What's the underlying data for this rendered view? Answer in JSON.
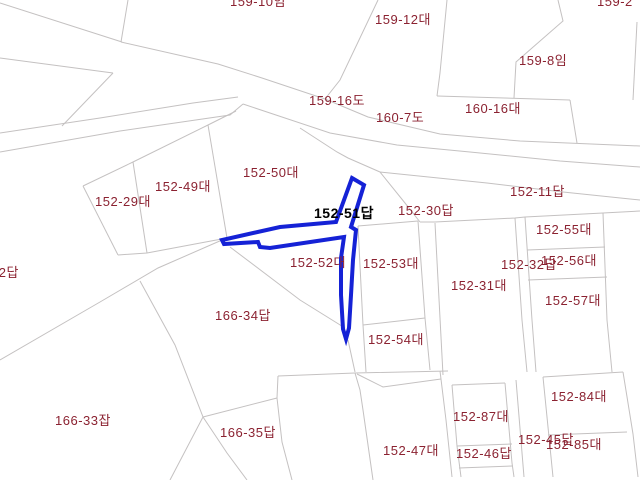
{
  "map": {
    "type": "cadastral-parcel-map",
    "background_color": "#ffffff",
    "boundary_line_color": "#c4c1c1",
    "parcel_label_color": "#8b2231",
    "highlight_outline_color": "#1522d6",
    "highlight_label_color": "#000000",
    "highlighted_parcel": {
      "label": "152-51답",
      "label_x": 314,
      "label_y": 206,
      "outline_points": [
        [
          352,
          178
        ],
        [
          364,
          185
        ],
        [
          351,
          227
        ],
        [
          356,
          230
        ],
        [
          353,
          260
        ],
        [
          351,
          295
        ],
        [
          349,
          328
        ],
        [
          346,
          339
        ],
        [
          343,
          329
        ],
        [
          341,
          295
        ],
        [
          341,
          258
        ],
        [
          344,
          237
        ],
        [
          270,
          248
        ],
        [
          260,
          247
        ],
        [
          258,
          242
        ],
        [
          224,
          244
        ],
        [
          222,
          240
        ],
        [
          280,
          227
        ],
        [
          336,
          222
        ]
      ]
    },
    "parcel_labels": [
      {
        "text": "159-10임",
        "x": 230,
        "y": -6
      },
      {
        "text": "159-12대",
        "x": 375,
        "y": 12
      },
      {
        "text": "159-2",
        "x": 597,
        "y": -6
      },
      {
        "text": "159-8임",
        "x": 519,
        "y": 53
      },
      {
        "text": "159-16도",
        "x": 309,
        "y": 93
      },
      {
        "text": "160-7도",
        "x": 376,
        "y": 110
      },
      {
        "text": "160-16대",
        "x": 465,
        "y": 101
      },
      {
        "text": "152-11답",
        "x": 510,
        "y": 184
      },
      {
        "text": "152-50대",
        "x": 243,
        "y": 165
      },
      {
        "text": "152-49대",
        "x": 155,
        "y": 179
      },
      {
        "text": "152-29대",
        "x": 95,
        "y": 194
      },
      {
        "text": "152-30답",
        "x": 398,
        "y": 203
      },
      {
        "text": "152-55대",
        "x": 536,
        "y": 222
      },
      {
        "text": "152-32답",
        "x": 501,
        "y": 257
      },
      {
        "text": "152-56대",
        "x": 541,
        "y": 253
      },
      {
        "text": "152-31대",
        "x": 451,
        "y": 278
      },
      {
        "text": "152-57대",
        "x": 545,
        "y": 293
      },
      {
        "text": "152-53대",
        "x": 363,
        "y": 256
      },
      {
        "text": "152-52대",
        "x": 290,
        "y": 255
      },
      {
        "text": "152-54대",
        "x": 368,
        "y": 332
      },
      {
        "text": "166-34답",
        "x": 215,
        "y": 308
      },
      {
        "text": "166-33잡",
        "x": 55,
        "y": 413
      },
      {
        "text": "166-35답",
        "x": 220,
        "y": 425
      },
      {
        "text": "152-87대",
        "x": 453,
        "y": 409
      },
      {
        "text": "152-47대",
        "x": 383,
        "y": 443
      },
      {
        "text": "152-46답",
        "x": 456,
        "y": 446
      },
      {
        "text": "152-84대",
        "x": 551,
        "y": 389
      },
      {
        "text": "152-45답",
        "x": 518,
        "y": 432
      },
      {
        "text": "152-85대",
        "x": 546,
        "y": 437
      },
      {
        "text": "32답",
        "x": -9,
        "y": 265
      }
    ],
    "boundary_lines": [
      [
        [
          0,
          3
        ],
        [
          122,
          42
        ]
      ],
      [
        [
          128,
          0
        ],
        [
          121,
          42
        ]
      ],
      [
        [
          121,
          42
        ],
        [
          218,
          64
        ],
        [
          262,
          78
        ],
        [
          325,
          99
        ]
      ],
      [
        [
          325,
          99
        ],
        [
          368,
          117
        ],
        [
          440,
          134
        ],
        [
          520,
          141
        ],
        [
          640,
          146
        ]
      ],
      [
        [
          0,
          58
        ],
        [
          113,
          73
        ]
      ],
      [
        [
          113,
          73
        ],
        [
          62,
          126
        ]
      ],
      [
        [
          0,
          133
        ],
        [
          100,
          118
        ],
        [
          193,
          103
        ],
        [
          238,
          97
        ]
      ],
      [
        [
          0,
          152
        ],
        [
          120,
          131
        ],
        [
          230,
          115
        ],
        [
          243,
          104
        ]
      ],
      [
        [
          243,
          104
        ],
        [
          330,
          133
        ],
        [
          397,
          145
        ],
        [
          470,
          152
        ],
        [
          560,
          161
        ],
        [
          640,
          167
        ]
      ],
      [
        [
          236,
          111
        ],
        [
          208,
          125
        ],
        [
          133,
          162
        ],
        [
          83,
          186
        ]
      ],
      [
        [
          83,
          186
        ],
        [
          118,
          255
        ]
      ],
      [
        [
          133,
          162
        ],
        [
          147,
          253
        ]
      ],
      [
        [
          118,
          255
        ],
        [
          147,
          253
        ],
        [
          227,
          238
        ]
      ],
      [
        [
          208,
          125
        ],
        [
          227,
          238
        ]
      ],
      [
        [
          300,
          128
        ],
        [
          337,
          152
        ],
        [
          348,
          158
        ],
        [
          380,
          172
        ]
      ],
      [
        [
          380,
          172
        ],
        [
          487,
          183
        ],
        [
          563,
          192
        ],
        [
          640,
          200
        ]
      ],
      [
        [
          380,
          172
        ],
        [
          405,
          203
        ],
        [
          420,
          222
        ]
      ],
      [
        [
          420,
          222
        ],
        [
          435,
          222
        ],
        [
          515,
          218
        ],
        [
          525,
          217
        ],
        [
          603,
          213
        ],
        [
          640,
          211
        ]
      ],
      [
        [
          358,
          226
        ],
        [
          363,
          325
        ],
        [
          366,
          372
        ]
      ],
      [
        [
          358,
          226
        ],
        [
          418,
          221
        ]
      ],
      [
        [
          418,
          221
        ],
        [
          425,
          318
        ],
        [
          430,
          370
        ]
      ],
      [
        [
          363,
          325
        ],
        [
          425,
          318
        ]
      ],
      [
        [
          278,
          376
        ],
        [
          355,
          373
        ],
        [
          448,
          371
        ]
      ],
      [
        [
          435,
          223
        ],
        [
          443,
          375
        ]
      ],
      [
        [
          515,
          218
        ],
        [
          522,
          320
        ],
        [
          527,
          372
        ]
      ],
      [
        [
          525,
          217
        ],
        [
          532,
          320
        ],
        [
          536,
          372
        ]
      ],
      [
        [
          603,
          213
        ],
        [
          607,
          320
        ],
        [
          612,
          372
        ]
      ],
      [
        [
          527,
          250
        ],
        [
          605,
          247
        ]
      ],
      [
        [
          528,
          280
        ],
        [
          607,
          277
        ]
      ],
      [
        [
          452,
          385
        ],
        [
          505,
          383
        ]
      ],
      [
        [
          543,
          377
        ],
        [
          623,
          372
        ]
      ],
      [
        [
          452,
          385
        ],
        [
          457,
          446
        ],
        [
          461,
          477
        ]
      ],
      [
        [
          505,
          383
        ],
        [
          512,
          463
        ],
        [
          514,
          477
        ]
      ],
      [
        [
          457,
          446
        ],
        [
          512,
          444
        ]
      ],
      [
        [
          459,
          468
        ],
        [
          513,
          466
        ]
      ],
      [
        [
          355,
          373
        ],
        [
          360,
          390
        ],
        [
          363,
          410
        ],
        [
          373,
          480
        ]
      ],
      [
        [
          357,
          374
        ],
        [
          383,
          387
        ],
        [
          441,
          379
        ]
      ],
      [
        [
          440,
          371
        ],
        [
          446,
          420
        ],
        [
          452,
          477
        ]
      ],
      [
        [
          516,
          380
        ],
        [
          524,
          477
        ]
      ],
      [
        [
          543,
          377
        ],
        [
          553,
          477
        ]
      ],
      [
        [
          548,
          435
        ],
        [
          627,
          432
        ]
      ],
      [
        [
          623,
          372
        ],
        [
          633,
          434
        ],
        [
          638,
          477
        ]
      ],
      [
        [
          0,
          360
        ],
        [
          100,
          302
        ],
        [
          158,
          268
        ],
        [
          222,
          240
        ]
      ],
      [
        [
          140,
          281
        ],
        [
          175,
          345
        ],
        [
          203,
          417
        ],
        [
          170,
          480
        ]
      ],
      [
        [
          230,
          247
        ],
        [
          300,
          300
        ],
        [
          345,
          328
        ]
      ],
      [
        [
          348,
          340
        ],
        [
          355,
          372
        ]
      ],
      [
        [
          203,
          417
        ],
        [
          277,
          398
        ]
      ],
      [
        [
          203,
          417
        ],
        [
          227,
          453
        ],
        [
          247,
          480
        ]
      ],
      [
        [
          277,
          398
        ],
        [
          282,
          442
        ],
        [
          292,
          480
        ]
      ],
      [
        [
          278,
          376
        ],
        [
          277,
          398
        ]
      ],
      [
        [
          378,
          0
        ],
        [
          340,
          80
        ],
        [
          325,
          99
        ]
      ],
      [
        [
          447,
          0
        ],
        [
          440,
          73
        ],
        [
          437,
          96
        ]
      ],
      [
        [
          437,
          96
        ],
        [
          570,
          100
        ]
      ],
      [
        [
          558,
          0
        ],
        [
          563,
          21
        ],
        [
          516,
          62
        ],
        [
          514,
          98
        ]
      ],
      [
        [
          570,
          100
        ],
        [
          577,
          143
        ]
      ],
      [
        [
          637,
          22
        ],
        [
          633,
          100
        ]
      ]
    ]
  }
}
